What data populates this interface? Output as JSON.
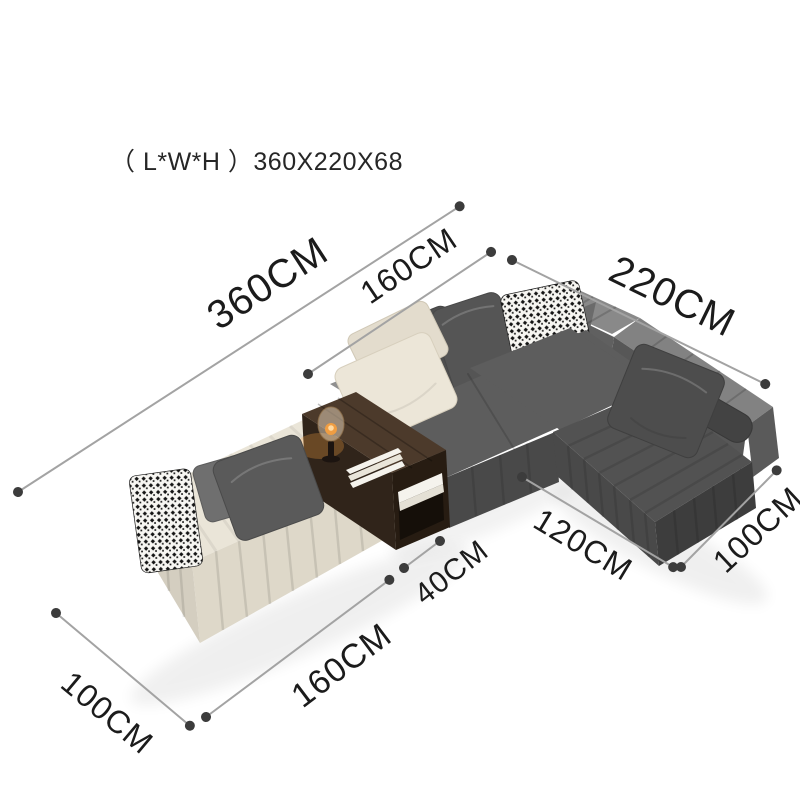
{
  "title": "（ L*W*H ）360X220X68",
  "dimensions": [
    {
      "id": "total-length",
      "label": "360CM"
    },
    {
      "id": "middle-section",
      "label": "160CM"
    },
    {
      "id": "right-side-length",
      "label": "220CM"
    },
    {
      "id": "chaise-length",
      "label": "120CM"
    },
    {
      "id": "chaise-depth",
      "label": "100CM"
    },
    {
      "id": "side-table-width",
      "label": "40CM"
    },
    {
      "id": "left-section-length",
      "label": "160CM"
    },
    {
      "id": "left-section-depth",
      "label": "100CM"
    }
  ],
  "colors": {
    "bg": "#ffffff",
    "line": "#a3a3a3",
    "dot": "#3c3c3c",
    "ink": "#1b1b1b",
    "cream": "#eae5d8",
    "cream-shade": "#ded8c9",
    "cream-side": "#d4cec0",
    "gray-seat": "#5d5d5d",
    "gray-front": "#494949",
    "gray-end": "#3d3d3d",
    "gray-back": "#8f8f8f",
    "wood": "#4c3a2b",
    "wood-dark": "#30241a",
    "paper": "#f5f3ed"
  }
}
